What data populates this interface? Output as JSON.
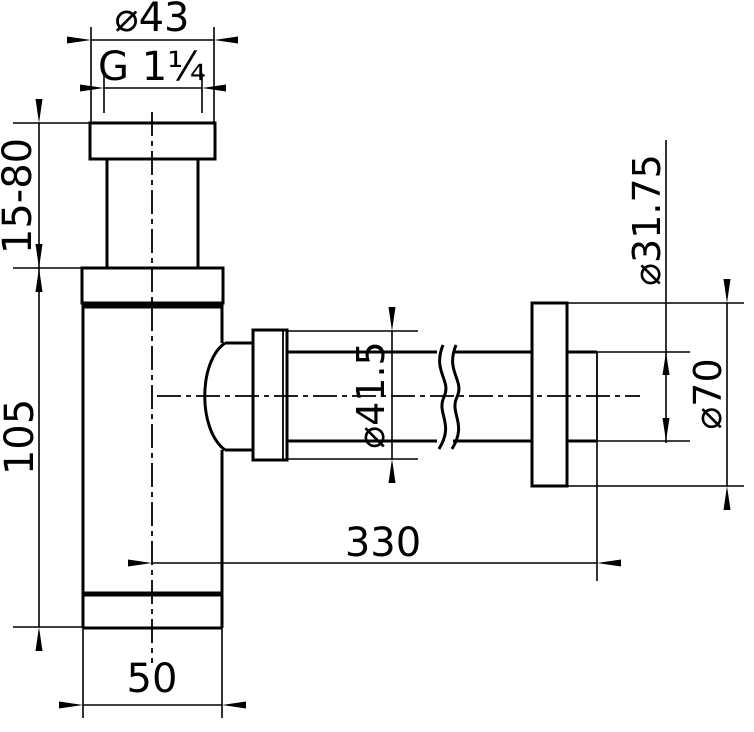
{
  "colors": {
    "ink": "#000000",
    "paper": "#ffffff"
  },
  "dimensions": {
    "inlet_nut_od": {
      "label": "⌀43"
    },
    "inlet_thread": {
      "label": "G 1¼"
    },
    "inlet_adjust_range": {
      "label": "15-80"
    },
    "body_height": {
      "label": "105"
    },
    "outlet_nut_od": {
      "label": "⌀41.5"
    },
    "outlet_pipe_od": {
      "label": "⌀31.75"
    },
    "wall_flange_od": {
      "label": "⌀70"
    },
    "outlet_reach": {
      "label": "330"
    },
    "body_od": {
      "label": "50"
    }
  }
}
